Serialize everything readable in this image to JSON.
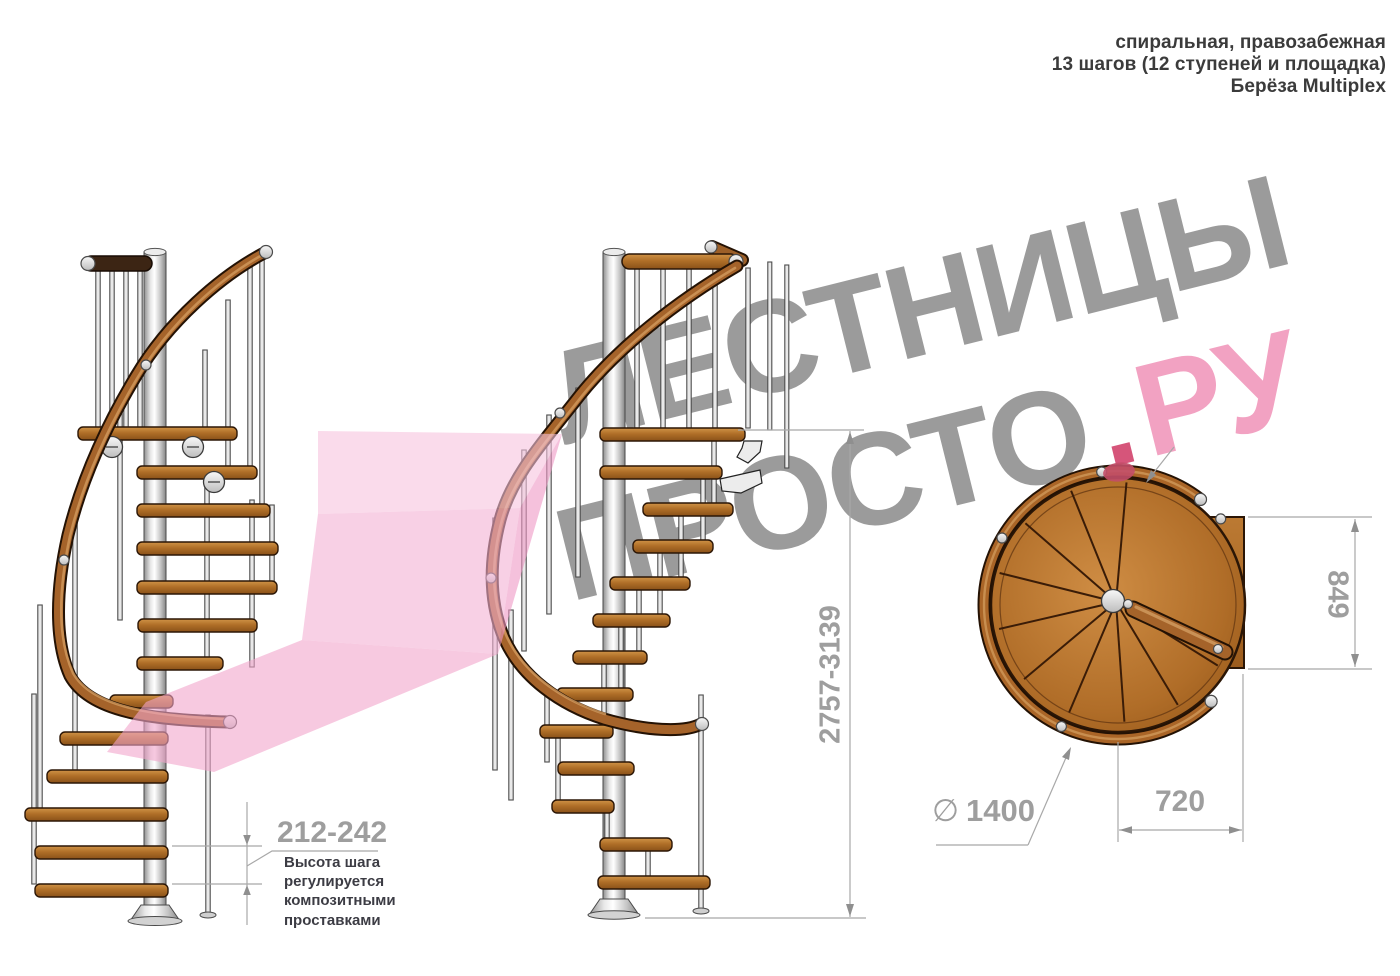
{
  "header": {
    "line1": "спиральная, правозабежная",
    "line2": "13 шагов (12 ступеней и площадка)",
    "line3": "Берёза Multiplex"
  },
  "watermark": {
    "word1": "ЛЕСТНИЦЫ",
    "word2": "ПРОСТО",
    "dot": ".",
    "word3": "РУ"
  },
  "annotations": {
    "step_height": {
      "value": "212-242",
      "note1": "Высота шага",
      "note2": "регулируется",
      "note3": "композитными",
      "note4": "проставками"
    },
    "total_height": {
      "value": "2757-3139"
    },
    "plan_depth": {
      "value": "849"
    },
    "plan_width": {
      "value": "720"
    },
    "diameter": {
      "symbol": "∅",
      "value": "1400"
    }
  },
  "colors": {
    "wood": "#a5632a",
    "metal": "#d9d9d9",
    "dimension_gray": "#9e9e9e",
    "watermark_gray": "#9b9b9b",
    "watermark_pink": "#f2a2c2",
    "arrow_pink": "#f4b1d4"
  }
}
